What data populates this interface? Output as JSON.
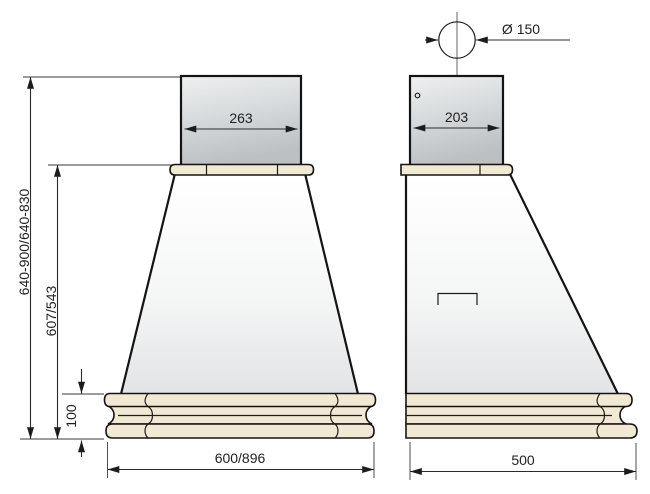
{
  "diagram": {
    "kind": "technical-dimension-drawing",
    "subject": "chimney cooker hood, front and side elevation",
    "front_view": {
      "chimney_width_mm": "263",
      "overall_height_mm": "640-900/640-830",
      "body_height_mm": "607/543",
      "base_height_mm": "100",
      "width_mm": "600/896"
    },
    "side_view": {
      "duct_diameter_mm": "Ø 150",
      "chimney_depth_mm": "203",
      "depth_mm": "500"
    },
    "colors": {
      "background": "#ffffff",
      "outline": "#141414",
      "dimension_line": "#2b2b2b",
      "wood_trim": "#f1e9d4",
      "metal_light": "#eceeef",
      "metal_dark": "#c0c4c6",
      "canopy_top": "#ffffff",
      "canopy_bottom": "#e3e5e6"
    }
  }
}
